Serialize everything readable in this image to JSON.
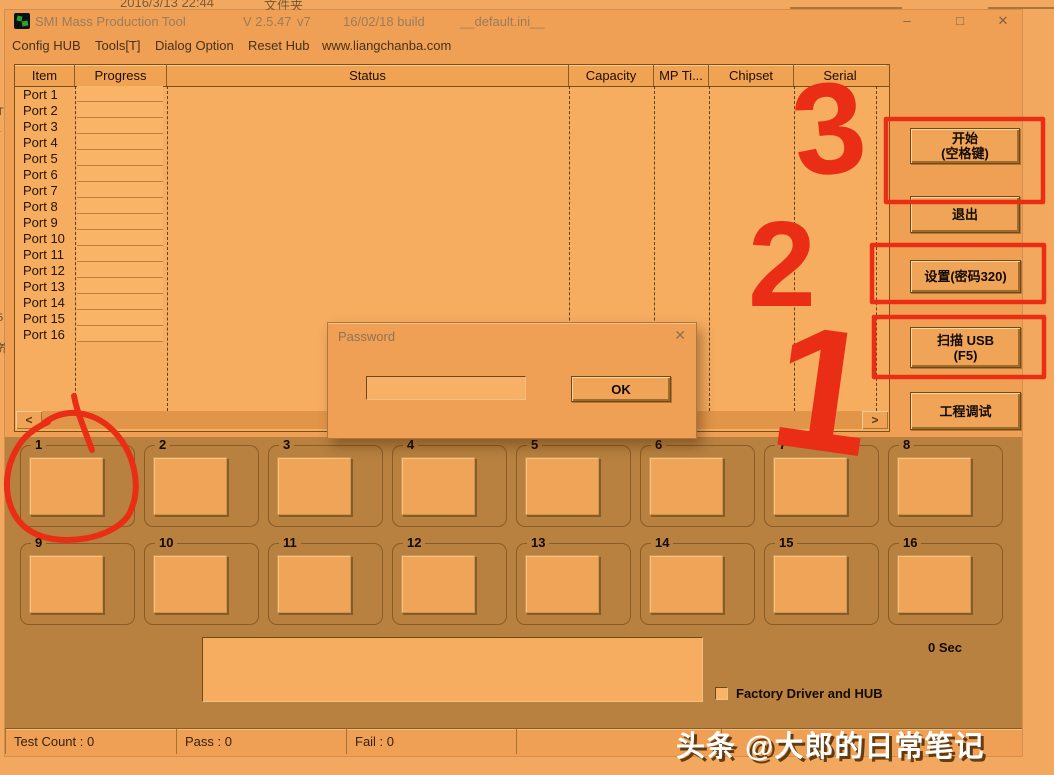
{
  "theme": {
    "window_orange": "#f0a054",
    "list_orange": "#f6ad60",
    "panel_brown": "#b8813f",
    "annotation_red": "#ea2e16"
  },
  "desktop": {
    "top_left_text": "2016/3/13 22:44",
    "top_right_text": "文件夹",
    "left_edge_fragments": [
      "T",
      "r",
      "5",
      "养"
    ]
  },
  "titlebar": {
    "app_title": "SMI Mass Production Tool",
    "version": "V 2.5.47",
    "sub_version": "v7",
    "build": "16/02/18 build",
    "ini_file": "__default.ini__",
    "minimize_glyph": "–",
    "maximize_glyph": "□",
    "close_glyph": "✕"
  },
  "menubar": {
    "items": [
      "Config HUB",
      "Tools[T]",
      "Dialog Option",
      "Reset Hub",
      "www.liangchanba.com"
    ]
  },
  "table": {
    "columns": [
      "Item",
      "Progress",
      "Status",
      "Capacity",
      "MP Ti...",
      "Chipset",
      "Serial"
    ],
    "rows": [
      "Port 1",
      "Port 2",
      "Port 3",
      "Port 4",
      "Port 5",
      "Port 6",
      "Port 7",
      "Port 8",
      "Port 9",
      "Port 10",
      "Port 11",
      "Port 12",
      "Port 13",
      "Port 14",
      "Port 15",
      "Port 16"
    ],
    "scroll_left_glyph": "<",
    "scroll_right_glyph": ">"
  },
  "side_panel": {
    "start_line1": "开始",
    "start_line2": "(空格键)",
    "exit_label": "退出",
    "settings_label": "设置(密码320)",
    "scan_line1": "扫描 USB",
    "scan_line2": "(F5)",
    "debug_label": "工程调试"
  },
  "password_dialog": {
    "title": "Password",
    "close_glyph": "✕",
    "input_value": "",
    "ok_label": "OK"
  },
  "slots": [
    "1",
    "2",
    "3",
    "4",
    "5",
    "6",
    "7",
    "8",
    "9",
    "10",
    "11",
    "12",
    "13",
    "14",
    "15",
    "16"
  ],
  "bottom_panel": {
    "elapsed": "0 Sec",
    "log_value": "",
    "factory_checkbox_label": "Factory Driver and HUB",
    "factory_checkbox_checked": false
  },
  "status_bar": {
    "cells": [
      "Test Count : 0",
      "Pass : 0",
      "Fail : 0",
      "",
      ""
    ]
  },
  "watermark": "头条 @大郎的日常笔记",
  "annotations": {
    "step_numbers": [
      "1",
      "2",
      "3"
    ]
  }
}
